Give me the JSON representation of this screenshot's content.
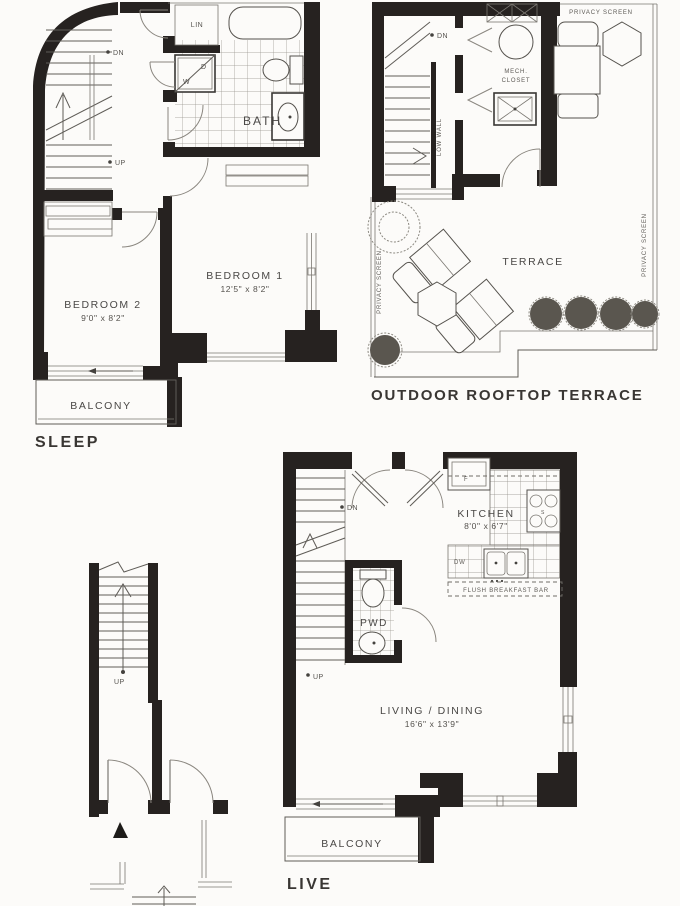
{
  "colors": {
    "paper": "#fcfbf9",
    "wall": "#262220",
    "line": "#5f5c57",
    "text": "#4a4846"
  },
  "sleep": {
    "title": "SLEEP",
    "bedroom1": "BEDROOM 1",
    "bedroom1_dims": "12'5\" x 8'2\"",
    "bedroom2": "BEDROOM 2",
    "bedroom2_dims": "9'0\" x 8'2\"",
    "bath": "BATH",
    "lin": "LIN",
    "washer": "W",
    "dryer": "D",
    "balcony": "BALCONY",
    "dn": "DN",
    "up": "UP"
  },
  "terrace": {
    "title": "OUTDOOR ROOFTOP TERRACE",
    "terrace": "TERRACE",
    "mech_line1": "MECH.",
    "mech_line2": "CLOSET",
    "privacy_top": "PRIVACY SCREEN",
    "privacy_left": "PRIVACY SCREEN",
    "privacy_right": "PRIVACY SCREEN",
    "low_wall": "LOW WALL",
    "dn": "DN"
  },
  "live": {
    "title": "LIVE",
    "kitchen": "KITCHEN",
    "kitchen_dims": "8'0\" x 6'7\"",
    "living": "LIVING / DINING",
    "living_dims": "16'6\" x 13'9\"",
    "balcony": "BALCONY",
    "pwd": "PWD",
    "fridge": "F",
    "stove": "S",
    "dishwasher": "DW",
    "breakfast_bar": "FLUSH BREAKFAST BAR",
    "dn": "DN",
    "up": "UP"
  },
  "entry": {
    "up": "UP"
  }
}
